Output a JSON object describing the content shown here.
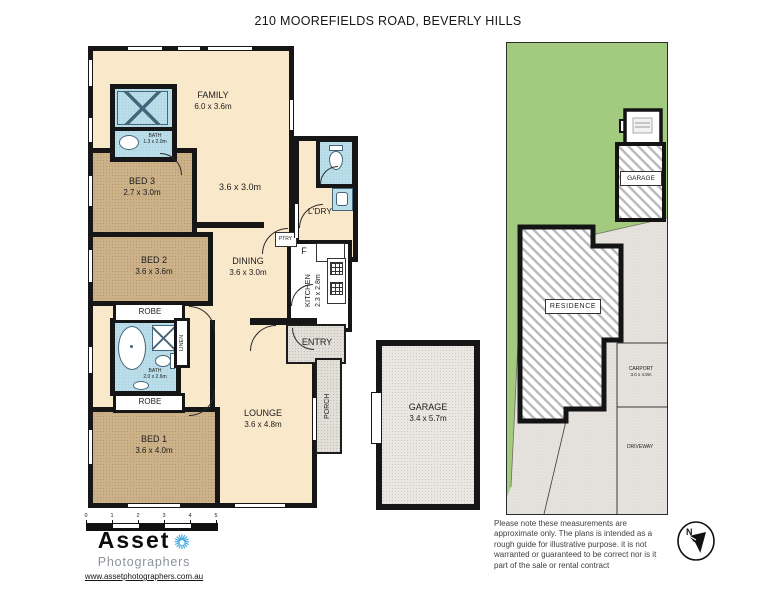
{
  "title": "210 MOOREFIELDS ROAD, BEVERLY HILLS",
  "floorplan": {
    "rooms": {
      "family": {
        "label": "FAMILY",
        "dims": "6.0 x 3.6m"
      },
      "living2": {
        "dims": "3.6 x 3.0m"
      },
      "bed3": {
        "label": "BED 3",
        "dims": "2.7 x 3.0m"
      },
      "bed2": {
        "label": "BED 2",
        "dims": "3.6 x 3.6m"
      },
      "bed1": {
        "label": "BED 1",
        "dims": "3.6 x 4.0m"
      },
      "dining": {
        "label": "DINING",
        "dims": "3.6 x 3.0m"
      },
      "kitchen": {
        "label": "KITCHEN",
        "dims": "2.3 x 2.8m"
      },
      "lounge": {
        "label": "LOUNGE",
        "dims": "3.6 x 4.8m"
      },
      "laundry": {
        "label": "L'DRY"
      },
      "entry": {
        "label": "ENTRY"
      },
      "porch": {
        "label": "PORCH"
      },
      "bath_top": {
        "label": "BATH",
        "dims": "1.3 x 2.0m"
      },
      "bath_main": {
        "label": "BATH",
        "dims": "2.0 x 2.6m"
      },
      "robe1": {
        "label": "ROBE"
      },
      "robe2": {
        "label": "ROBE"
      },
      "linen": {
        "label": "LINEN"
      },
      "fridge": {
        "label": "F"
      },
      "pantry": {
        "label": "PTRY"
      }
    },
    "garage": {
      "label": "GARAGE",
      "dims": "3.4 x 5.7m"
    }
  },
  "siteplan": {
    "garage_label": "GARAGE",
    "residence_label": "RESIDENCE",
    "carport_label": "CARPORT",
    "carport_dims": "3.0 x 4.9m",
    "driveway_label": "DRIVEWAY"
  },
  "scalebar": {
    "ticks": [
      "0",
      "1",
      "2",
      "3",
      "4",
      "5"
    ]
  },
  "branding": {
    "name": "Asset",
    "tagline": "Photographers",
    "url": "www.assetphotographers.com.au"
  },
  "disclaimer": "Please note these measurements are approximate only. The plans is intended as a rough guide for illustrative purpose. it is not warranted or guaranteed to be correct nor is it part of the sale or rental contract",
  "colors": {
    "wall": "#161616",
    "cream": "#FAE8CA",
    "tan": "#CDB189",
    "fixture_blue": "#B9DEEA",
    "lawn": "#A3CB7F",
    "paving": "#E6E3DE",
    "logo_blue": "#41A8E0"
  }
}
